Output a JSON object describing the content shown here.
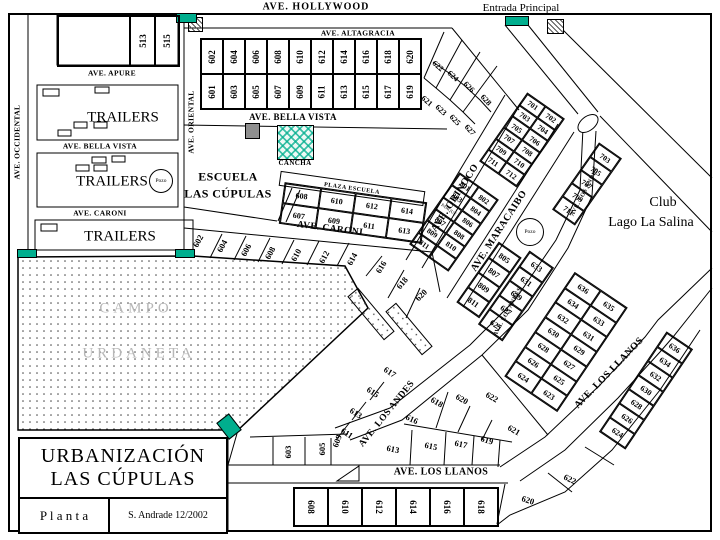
{
  "header": {
    "hollywood": "AVE. HOLLYWOOD",
    "entrada": "Entrada Principal"
  },
  "title_block": {
    "line1": "URBANIZACIÓN",
    "line2": "LAS CÚPULAS",
    "plan": "P l a n t a",
    "credit": "S. Andrade 12/2002"
  },
  "labels": {
    "pozo": "Pozo",
    "plaza_escuela": "PLAZA ESCUELA"
  },
  "colors": {
    "teal": "#00AE8E",
    "gray_marker": "#8f8f8f",
    "campo_text": "#b7b7b7"
  },
  "streets": [
    {
      "t": "AVE. ALTAGRACIA",
      "x": 358,
      "y": 33,
      "r": 0,
      "s": 7.5,
      "c": "st"
    },
    {
      "t": "AVE. APURE",
      "x": 112,
      "y": 73,
      "r": 0,
      "s": 7.5,
      "c": "st"
    },
    {
      "t": "AVE. OCCIDENTAL",
      "x": 17,
      "y": 142,
      "r": -90,
      "s": 7.5,
      "c": "st"
    },
    {
      "t": "AVE. ORIENTAL",
      "x": 191,
      "y": 122,
      "r": -90,
      "s": 7.5,
      "c": "st"
    },
    {
      "t": "AVE. BELLA VISTA",
      "x": 100,
      "y": 146,
      "r": 0,
      "s": 7.5,
      "c": "st"
    },
    {
      "t": "AVE. BELLA VISTA",
      "x": 293,
      "y": 117,
      "r": 0,
      "s": 9,
      "c": "st"
    },
    {
      "t": "AVE. CARONI",
      "x": 100,
      "y": 213,
      "r": 0,
      "s": 7.5,
      "c": "st"
    },
    {
      "t": "AVE. CARONI",
      "x": 330,
      "y": 229,
      "r": 7,
      "s": 9.5,
      "c": "st"
    },
    {
      "t": "AVE. ORINOCO",
      "x": 455,
      "y": 198,
      "r": -57,
      "s": 10,
      "c": "st"
    },
    {
      "t": "AVE. MARACAIBO",
      "x": 499,
      "y": 231,
      "r": -57,
      "s": 10,
      "c": "st"
    },
    {
      "t": "AVE. LOS ANDES",
      "x": 585,
      "y": 192,
      "r": -62,
      "s": 6,
      "c": "st"
    },
    {
      "t": "AVE. LOS ANDES",
      "x": 508,
      "y": 312,
      "r": -62,
      "s": 6,
      "c": "st"
    },
    {
      "t": "AVE. LOS ANDES",
      "x": 387,
      "y": 414,
      "r": -51,
      "s": 9.5,
      "c": "st"
    },
    {
      "t": "AVE. LOS LLANOS",
      "x": 441,
      "y": 472,
      "r": 0,
      "s": 10,
      "c": "st"
    },
    {
      "t": "AVE. LOS LLANOS",
      "x": 609,
      "y": 373,
      "r": -46,
      "s": 10,
      "c": "st"
    }
  ],
  "places": [
    {
      "t": "ESCUELA",
      "x": 228,
      "y": 177,
      "r": 0,
      "s": 12,
      "c": "st"
    },
    {
      "t": "LAS CÚPULAS",
      "x": 228,
      "y": 194,
      "r": 0,
      "s": 12,
      "c": "st"
    },
    {
      "t": "CANCHA",
      "x": 295,
      "y": 163,
      "r": 0,
      "s": 7,
      "c": "st"
    },
    {
      "t": "Club",
      "x": 663,
      "y": 203,
      "r": 0,
      "s": 14,
      "c": "serif"
    },
    {
      "t": "Lago La Salina",
      "x": 651,
      "y": 223,
      "r": 0,
      "s": 14,
      "c": "serif"
    },
    {
      "t": "CAMPO",
      "x": 136,
      "y": 309,
      "r": 0,
      "s": 15,
      "c": "campo"
    },
    {
      "t": "URDANETA",
      "x": 139,
      "y": 354,
      "r": 0,
      "s": 15,
      "c": "campo"
    },
    {
      "t": "TRAILERS",
      "x": 123,
      "y": 118,
      "r": 0,
      "s": 15,
      "c": "serif"
    },
    {
      "t": "TRAILERS",
      "x": 112,
      "y": 182,
      "r": 0,
      "s": 15,
      "c": "serif"
    },
    {
      "t": "TRAILERS",
      "x": 120,
      "y": 237,
      "r": 0,
      "s": 15,
      "c": "serif"
    }
  ],
  "lots": {
    "grid_600_top": [
      "602",
      "604",
      "606",
      "608",
      "610",
      "612",
      "614",
      "616",
      "618",
      "620",
      "601",
      "603",
      "605",
      "607",
      "609",
      "611",
      "613",
      "615",
      "617",
      "619"
    ],
    "block_513": [
      "",
      "513",
      "515"
    ],
    "plaza_grid": [
      "608",
      "610",
      "612",
      "614",
      "607",
      "609",
      "611",
      "613"
    ],
    "block_700": [
      "701",
      "702",
      "703",
      "704",
      "705",
      "706",
      "707",
      "708",
      "709",
      "710",
      "711",
      "712"
    ],
    "col_700_east": [
      "703",
      "705",
      "707",
      "709",
      "711"
    ],
    "block_800": [
      "801",
      "802",
      "803",
      "804",
      {
        "t": "PARQUE",
        "small": true
      },
      "806",
      "807",
      "808",
      "809",
      "810",
      "811",
      ""
    ],
    "col_800_east": [
      "805",
      "807",
      "809",
      "811"
    ],
    "col_600_upper": [
      "633",
      "631",
      "629",
      "627",
      "625"
    ],
    "wedge_andes_llanos": [
      "636",
      "635",
      "634",
      "633",
      "632",
      "631",
      "630",
      "629",
      "628",
      "627",
      "626",
      "625",
      "624",
      "623"
    ],
    "col_llanos_east": [
      "636",
      "634",
      "632",
      "630",
      "628",
      "626",
      "624"
    ],
    "row_south": [
      "608",
      "610",
      "612",
      "614",
      "616",
      "618"
    ],
    "fan": [
      {
        "t": "622",
        "x": 438,
        "y": 66,
        "r": 40,
        "s": 8
      },
      {
        "t": "624",
        "x": 453,
        "y": 76,
        "r": 43,
        "s": 8
      },
      {
        "t": "626",
        "x": 469,
        "y": 87,
        "r": 46,
        "s": 8
      },
      {
        "t": "628",
        "x": 486,
        "y": 100,
        "r": 48,
        "s": 8
      },
      {
        "t": "621",
        "x": 427,
        "y": 101,
        "r": 40,
        "s": 8
      },
      {
        "t": "623",
        "x": 441,
        "y": 110,
        "r": 43,
        "s": 8
      },
      {
        "t": "625",
        "x": 455,
        "y": 120,
        "r": 46,
        "s": 8
      },
      {
        "t": "627",
        "x": 470,
        "y": 130,
        "r": 48,
        "s": 8
      }
    ],
    "row_caroni": [
      {
        "t": "602",
        "x": 198,
        "y": 241,
        "r": -62,
        "s": 8.5
      },
      {
        "t": "604",
        "x": 222,
        "y": 246,
        "r": -62,
        "s": 8.5
      },
      {
        "t": "606",
        "x": 246,
        "y": 250,
        "r": -62,
        "s": 8.5
      },
      {
        "t": "608",
        "x": 270,
        "y": 253,
        "r": -62,
        "s": 8.5
      },
      {
        "t": "610",
        "x": 296,
        "y": 255,
        "r": -62,
        "s": 8.5
      },
      {
        "t": "612",
        "x": 324,
        "y": 257,
        "r": -62,
        "s": 8.5
      },
      {
        "t": "614",
        "x": 352,
        "y": 259,
        "r": -62,
        "s": 8.5
      },
      {
        "t": "616",
        "x": 381,
        "y": 267,
        "r": -58,
        "s": 8.5
      },
      {
        "t": "618",
        "x": 402,
        "y": 283,
        "r": -50,
        "s": 8.5
      },
      {
        "t": "620",
        "x": 421,
        "y": 295,
        "r": -45,
        "s": 8.5
      }
    ],
    "cluster_llanos": [
      {
        "t": "616",
        "x": 412,
        "y": 419,
        "r": 25,
        "s": 8.5
      },
      {
        "t": "618",
        "x": 437,
        "y": 402,
        "r": 30,
        "s": 8.5
      },
      {
        "t": "620",
        "x": 462,
        "y": 399,
        "r": 30,
        "s": 8.5
      },
      {
        "t": "622",
        "x": 492,
        "y": 397,
        "r": 30,
        "s": 8.5
      },
      {
        "t": "613",
        "x": 393,
        "y": 449,
        "r": 12,
        "s": 8.5
      },
      {
        "t": "615",
        "x": 431,
        "y": 446,
        "r": 12,
        "s": 8.5
      },
      {
        "t": "617",
        "x": 461,
        "y": 444,
        "r": 12,
        "s": 8.5
      },
      {
        "t": "619",
        "x": 487,
        "y": 440,
        "r": 18,
        "s": 8.5
      },
      {
        "t": "621",
        "x": 514,
        "y": 430,
        "r": 30,
        "s": 8.5
      },
      {
        "t": "622",
        "x": 570,
        "y": 479,
        "r": 25,
        "s": 8.5
      },
      {
        "t": "620",
        "x": 528,
        "y": 500,
        "r": 18,
        "s": 8.5
      }
    ],
    "southwest": [
      {
        "t": "603",
        "x": 288,
        "y": 452,
        "r": -90,
        "s": 8.5
      },
      {
        "t": "605",
        "x": 322,
        "y": 449,
        "r": -90,
        "s": 8.5
      },
      {
        "t": "609",
        "x": 337,
        "y": 441,
        "r": -70,
        "s": 8.5
      },
      {
        "t": "611",
        "x": 347,
        "y": 433,
        "r": 33,
        "s": 8.5
      },
      {
        "t": "613",
        "x": 356,
        "y": 413,
        "r": 33,
        "s": 8.5
      },
      {
        "t": "615",
        "x": 373,
        "y": 392,
        "r": 33,
        "s": 8.5
      },
      {
        "t": "617",
        "x": 390,
        "y": 372,
        "r": 33,
        "s": 8.5
      }
    ]
  }
}
